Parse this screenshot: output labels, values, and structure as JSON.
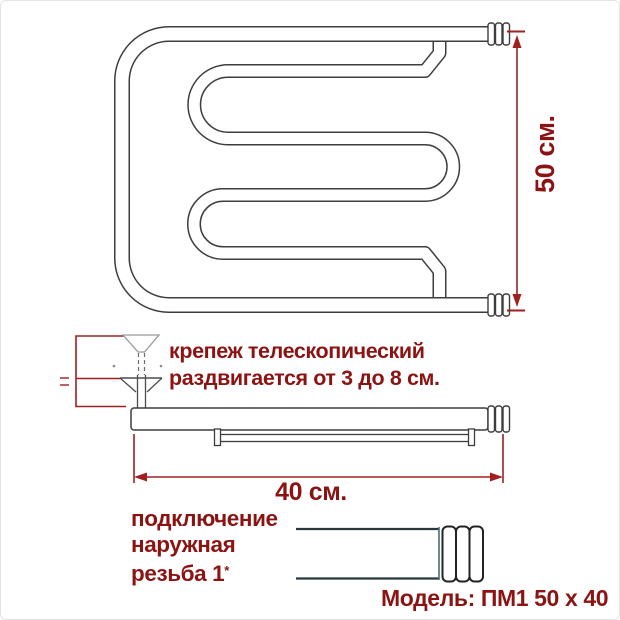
{
  "diagram": {
    "height_label": "50 см.",
    "width_label": "40 см.",
    "mount_note_line1": "крепеж телескопический",
    "mount_note_line2": "раздвигается от 3 до 8 см.",
    "connection_line1": "подключение",
    "connection_line2": "наружная",
    "connection_line3": "резьба 1",
    "thread_mark": "*",
    "model_label": "Модель: ПМ1 50 x 40"
  },
  "colors": {
    "text_red": "#8b1413",
    "dimension_red": "#a02020",
    "line_dark": "#3d3d3d"
  }
}
